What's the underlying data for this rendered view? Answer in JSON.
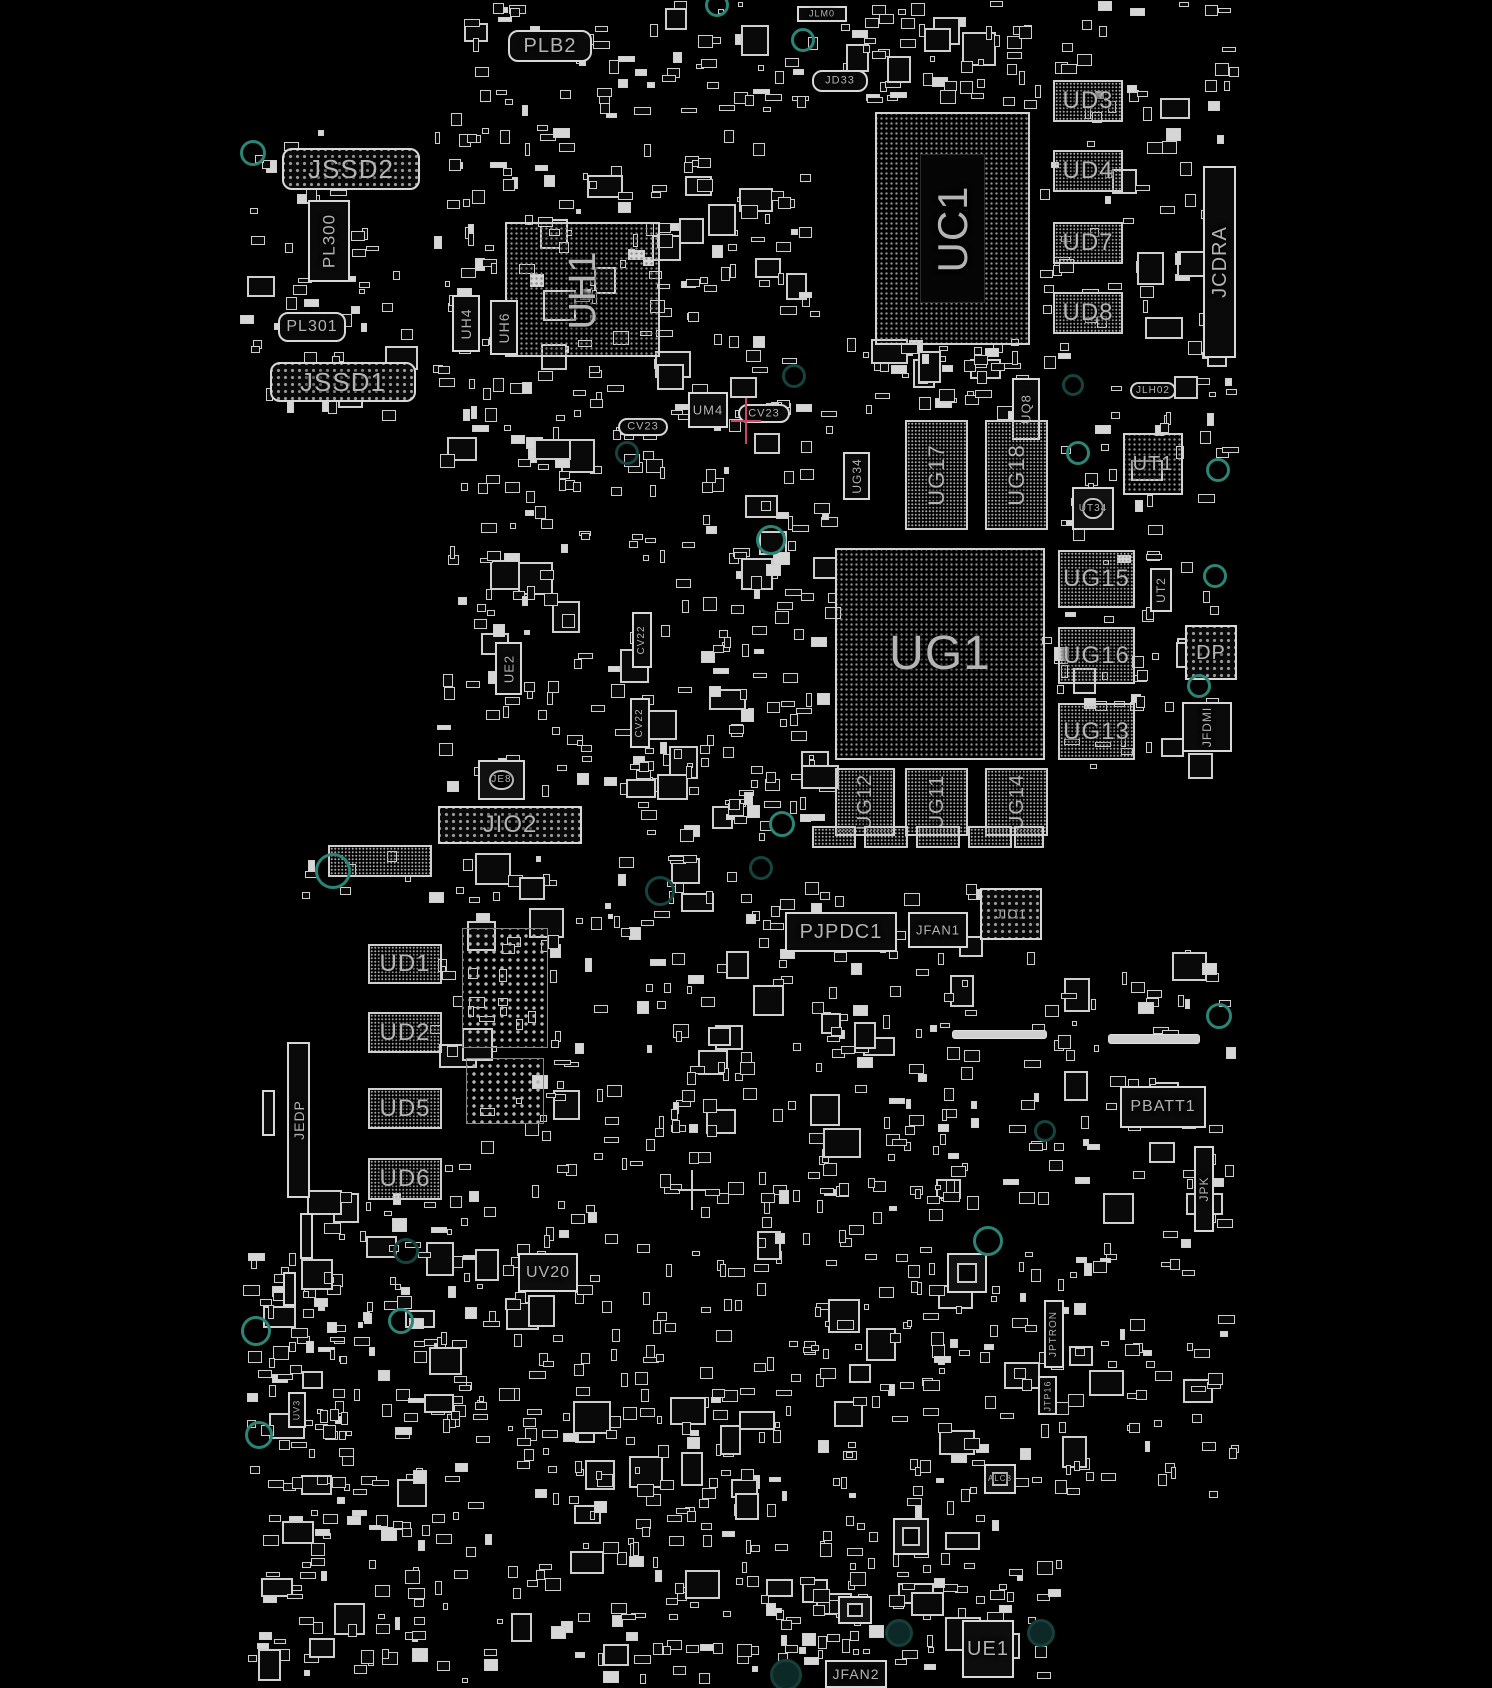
{
  "app": {
    "title": "PCB boardview — component placement"
  },
  "colors": {
    "background": "#000000",
    "silkscreen": "#d2d2d2",
    "label": "#b4b4b4",
    "mounting_hole": "#2b8577",
    "selection_cross": "#cc4466"
  },
  "boards": [
    {
      "name": "top-board",
      "elements": [
        {
          "type": "conn",
          "label": "JSSD2",
          "x": 282,
          "y": 148,
          "w": 138,
          "h": 42,
          "size": 26,
          "round": true,
          "pins": true
        },
        {
          "type": "vconn",
          "label": "PL300",
          "x": 308,
          "y": 200,
          "w": 42,
          "h": 82,
          "size": 17
        },
        {
          "type": "conn",
          "label": "PL301",
          "x": 278,
          "y": 312,
          "w": 68,
          "h": 30,
          "size": 16,
          "round": true
        },
        {
          "type": "conn",
          "label": "JSSD1",
          "x": 270,
          "y": 362,
          "w": 146,
          "h": 40,
          "size": 26,
          "round": true,
          "pins": true
        },
        {
          "type": "conn",
          "label": "PLB2",
          "x": 508,
          "y": 30,
          "w": 84,
          "h": 32,
          "size": 20,
          "round": true
        },
        {
          "type": "conn",
          "label": "JLM0",
          "x": 797,
          "y": 6,
          "w": 50,
          "h": 16,
          "size": 9
        },
        {
          "type": "conn",
          "label": "JD33",
          "x": 812,
          "y": 70,
          "w": 56,
          "h": 22,
          "size": 11,
          "round": true
        },
        {
          "type": "bga",
          "label": "UH1",
          "x": 505,
          "y": 222,
          "w": 155,
          "h": 135,
          "size": 38,
          "vert": true
        },
        {
          "type": "vconn",
          "label": "UH4",
          "x": 452,
          "y": 295,
          "w": 28,
          "h": 57,
          "size": 14
        },
        {
          "type": "vconn",
          "label": "UH6",
          "x": 490,
          "y": 300,
          "w": 28,
          "h": 55,
          "size": 14
        },
        {
          "type": "bga",
          "label": "UC1",
          "x": 875,
          "y": 112,
          "w": 155,
          "h": 233,
          "size": 42,
          "vert": true,
          "ring": true
        },
        {
          "type": "hatch",
          "label": "UD3",
          "x": 1053,
          "y": 80,
          "w": 70,
          "h": 42,
          "size": 24
        },
        {
          "type": "hatch",
          "label": "UD4",
          "x": 1053,
          "y": 150,
          "w": 70,
          "h": 42,
          "size": 24
        },
        {
          "type": "hatch",
          "label": "UD7",
          "x": 1053,
          "y": 222,
          "w": 70,
          "h": 42,
          "size": 24
        },
        {
          "type": "hatch",
          "label": "UD8",
          "x": 1053,
          "y": 292,
          "w": 70,
          "h": 42,
          "size": 24
        },
        {
          "type": "vconn",
          "label": "JCDRA",
          "x": 1203,
          "y": 166,
          "w": 33,
          "h": 192,
          "size": 20
        },
        {
          "type": "chip",
          "label": "UM4",
          "x": 688,
          "y": 392,
          "w": 40,
          "h": 36,
          "size": 13
        },
        {
          "type": "conn",
          "label": "CV23",
          "x": 738,
          "y": 404,
          "w": 52,
          "h": 19,
          "size": 11,
          "round": true
        },
        {
          "type": "conn",
          "label": "CV23",
          "x": 618,
          "y": 418,
          "w": 50,
          "h": 18,
          "size": 11,
          "round": true
        },
        {
          "type": "vconn",
          "label": "UG34",
          "x": 843,
          "y": 452,
          "w": 27,
          "h": 48,
          "size": 12
        },
        {
          "type": "vconn",
          "label": "UQ8",
          "x": 1012,
          "y": 378,
          "w": 28,
          "h": 62,
          "size": 13
        },
        {
          "type": "conn",
          "label": "JLH02",
          "x": 1130,
          "y": 382,
          "w": 46,
          "h": 17,
          "size": 10,
          "round": true
        },
        {
          "type": "hatch",
          "label": "UG17",
          "x": 905,
          "y": 420,
          "w": 63,
          "h": 110,
          "size": 22,
          "vert": true
        },
        {
          "type": "hatch",
          "label": "UG18",
          "x": 985,
          "y": 420,
          "w": 63,
          "h": 110,
          "size": 22,
          "vert": true
        },
        {
          "type": "bga",
          "label": "UT1",
          "x": 1123,
          "y": 433,
          "w": 60,
          "h": 62,
          "size": 20
        },
        {
          "type": "qfn",
          "label": "UT34",
          "x": 1072,
          "y": 487,
          "w": 42,
          "h": 43,
          "size": 10,
          "circle": true
        },
        {
          "type": "bga",
          "label": "UG1",
          "x": 835,
          "y": 548,
          "w": 210,
          "h": 212,
          "size": 48
        },
        {
          "type": "hatch",
          "label": "UG15",
          "x": 1058,
          "y": 550,
          "w": 77,
          "h": 58,
          "size": 24
        },
        {
          "type": "hatch",
          "label": "UG16",
          "x": 1058,
          "y": 627,
          "w": 77,
          "h": 57,
          "size": 24
        },
        {
          "type": "hatch",
          "label": "UG13",
          "x": 1058,
          "y": 703,
          "w": 77,
          "h": 57,
          "size": 24
        },
        {
          "type": "vconn",
          "label": "UT2",
          "x": 1150,
          "y": 568,
          "w": 22,
          "h": 44,
          "size": 12
        },
        {
          "type": "conn",
          "label": "DP",
          "x": 1185,
          "y": 625,
          "w": 52,
          "h": 55,
          "size": 20,
          "pins": true
        },
        {
          "type": "vconn",
          "label": "JFDMI",
          "x": 1182,
          "y": 702,
          "w": 50,
          "h": 50,
          "size": 12
        },
        {
          "type": "hatch",
          "label": "UG12",
          "x": 835,
          "y": 768,
          "w": 60,
          "h": 68,
          "size": 20,
          "vert": true
        },
        {
          "type": "hatch",
          "label": "UG11",
          "x": 905,
          "y": 768,
          "w": 63,
          "h": 68,
          "size": 20,
          "vert": true
        },
        {
          "type": "hatch",
          "label": "UG14",
          "x": 985,
          "y": 768,
          "w": 63,
          "h": 68,
          "size": 20,
          "vert": true
        },
        {
          "type": "vconn",
          "label": "UE2",
          "x": 495,
          "y": 642,
          "w": 27,
          "h": 53,
          "size": 13
        },
        {
          "type": "qfn",
          "label": "JE8",
          "x": 478,
          "y": 760,
          "w": 47,
          "h": 40,
          "size": 10,
          "circle": true
        },
        {
          "type": "vconn",
          "label": "CV22",
          "x": 632,
          "y": 612,
          "w": 20,
          "h": 56,
          "size": 10
        },
        {
          "type": "vconn",
          "label": "CV22",
          "x": 630,
          "y": 698,
          "w": 20,
          "h": 50,
          "size": 10
        },
        {
          "type": "conn",
          "label": "JIO2",
          "x": 438,
          "y": 806,
          "w": 144,
          "h": 38,
          "size": 24,
          "pins": true
        },
        {
          "type": "hatch",
          "label": "",
          "x": 812,
          "y": 826,
          "w": 44,
          "h": 22
        },
        {
          "type": "hatch",
          "label": "",
          "x": 864,
          "y": 826,
          "w": 44,
          "h": 22
        },
        {
          "type": "hatch",
          "label": "",
          "x": 916,
          "y": 826,
          "w": 44,
          "h": 22
        },
        {
          "type": "hatch",
          "label": "",
          "x": 968,
          "y": 826,
          "w": 44,
          "h": 22
        },
        {
          "type": "hatch",
          "label": "",
          "x": 1014,
          "y": 826,
          "w": 30,
          "h": 22
        },
        {
          "type": "hole",
          "x": 250,
          "y": 150,
          "r": 10
        },
        {
          "type": "hole",
          "x": 714,
          "y": 2,
          "r": 9
        },
        {
          "type": "hole",
          "x": 800,
          "y": 37,
          "r": 9
        },
        {
          "type": "hole",
          "x": 624,
          "y": 450,
          "r": 9,
          "dark": true
        },
        {
          "type": "hole",
          "x": 791,
          "y": 373,
          "r": 9,
          "dark": true
        },
        {
          "type": "hole",
          "x": 1070,
          "y": 382,
          "r": 8,
          "dark": true
        },
        {
          "type": "hole",
          "x": 1075,
          "y": 450,
          "r": 9
        },
        {
          "type": "hole",
          "x": 1215,
          "y": 467,
          "r": 9
        },
        {
          "type": "hole",
          "x": 768,
          "y": 537,
          "r": 12
        },
        {
          "type": "hole",
          "x": 1212,
          "y": 573,
          "r": 9
        },
        {
          "type": "hole",
          "x": 1196,
          "y": 683,
          "r": 9
        },
        {
          "type": "hole",
          "x": 779,
          "y": 821,
          "r": 10
        },
        {
          "type": "hole",
          "x": 758,
          "y": 865,
          "r": 9,
          "dark": true
        },
        {
          "type": "hole",
          "x": 657,
          "y": 888,
          "r": 12,
          "dark": true
        },
        {
          "type": "cross",
          "x": 746,
          "y": 421,
          "w": 30,
          "h": 46,
          "color": "#cc4466"
        }
      ]
    },
    {
      "name": "bottom-board",
      "elements": [
        {
          "type": "hatch",
          "label": "",
          "x": 328,
          "y": 845,
          "w": 104,
          "h": 32
        },
        {
          "type": "conn",
          "label": "PJPDC1",
          "x": 785,
          "y": 912,
          "w": 112,
          "h": 40,
          "size": 20,
          "pins": false
        },
        {
          "type": "conn",
          "label": "JFAN1",
          "x": 908,
          "y": 912,
          "w": 60,
          "h": 36,
          "size": 13
        },
        {
          "type": "conn",
          "label": "JIO1",
          "x": 980,
          "y": 888,
          "w": 62,
          "h": 52,
          "size": 13,
          "pins": true
        },
        {
          "type": "hatch",
          "label": "UD1",
          "x": 368,
          "y": 944,
          "w": 74,
          "h": 40,
          "size": 24
        },
        {
          "type": "hatch",
          "label": "UD2",
          "x": 368,
          "y": 1012,
          "w": 74,
          "h": 41,
          "size": 24
        },
        {
          "type": "hatch",
          "label": "UD5",
          "x": 368,
          "y": 1088,
          "w": 74,
          "h": 41,
          "size": 24
        },
        {
          "type": "hatch",
          "label": "UD6",
          "x": 368,
          "y": 1158,
          "w": 74,
          "h": 42,
          "size": 24
        },
        {
          "type": "vconn",
          "label": "JEDP",
          "x": 287,
          "y": 1042,
          "w": 23,
          "h": 156,
          "size": 14
        },
        {
          "type": "pingrid",
          "x": 462,
          "y": 928,
          "w": 86,
          "h": 120
        },
        {
          "type": "pingrid",
          "x": 466,
          "y": 1058,
          "w": 78,
          "h": 66
        },
        {
          "type": "chip",
          "label": "UV20",
          "x": 518,
          "y": 1253,
          "w": 60,
          "h": 39,
          "size": 16
        },
        {
          "type": "conn",
          "label": "PBATT1",
          "x": 1120,
          "y": 1086,
          "w": 86,
          "h": 42,
          "size": 16
        },
        {
          "type": "bar",
          "x": 1108,
          "y": 1034,
          "w": 92,
          "h": 10
        },
        {
          "type": "bar",
          "x": 952,
          "y": 1030,
          "w": 95,
          "h": 9
        },
        {
          "type": "vconn",
          "label": "JPK",
          "x": 1194,
          "y": 1146,
          "w": 20,
          "h": 86,
          "size": 12
        },
        {
          "type": "qfn",
          "label": "",
          "x": 947,
          "y": 1253,
          "w": 40,
          "h": 40
        },
        {
          "type": "vconn",
          "label": "JPTRON",
          "x": 1044,
          "y": 1300,
          "w": 20,
          "h": 68,
          "size": 10
        },
        {
          "type": "vconn",
          "label": "JTP16",
          "x": 1038,
          "y": 1376,
          "w": 19,
          "h": 39,
          "size": 9
        },
        {
          "type": "vconn",
          "label": "UV3",
          "x": 288,
          "y": 1392,
          "w": 18,
          "h": 36,
          "size": 9
        },
        {
          "type": "qfn",
          "label": "ALC8",
          "x": 984,
          "y": 1464,
          "w": 32,
          "h": 30,
          "size": 8
        },
        {
          "type": "qfn",
          "label": "",
          "x": 893,
          "y": 1518,
          "w": 36,
          "h": 37
        },
        {
          "type": "qfn",
          "label": "",
          "x": 838,
          "y": 1596,
          "w": 34,
          "h": 28
        },
        {
          "type": "chip",
          "label": "UE1",
          "x": 962,
          "y": 1620,
          "w": 52,
          "h": 58,
          "size": 20
        },
        {
          "type": "conn",
          "label": "JFAN2",
          "x": 825,
          "y": 1660,
          "w": 62,
          "h": 28,
          "size": 14
        },
        {
          "type": "vconn",
          "label": "",
          "x": 262,
          "y": 1090,
          "w": 13,
          "h": 46
        },
        {
          "type": "vconn",
          "label": "",
          "x": 300,
          "y": 1213,
          "w": 13,
          "h": 46
        },
        {
          "type": "vconn",
          "label": "",
          "x": 283,
          "y": 1272,
          "w": 13,
          "h": 34
        },
        {
          "type": "hole",
          "x": 330,
          "y": 868,
          "r": 15
        },
        {
          "type": "hole",
          "x": 403,
          "y": 1248,
          "r": 10,
          "dark": true
        },
        {
          "type": "hole",
          "x": 253,
          "y": 1328,
          "r": 12
        },
        {
          "type": "hole",
          "x": 398,
          "y": 1318,
          "r": 10
        },
        {
          "type": "hole",
          "x": 256,
          "y": 1432,
          "r": 11
        },
        {
          "type": "hole",
          "x": 1216,
          "y": 1013,
          "r": 10
        },
        {
          "type": "hole",
          "x": 1042,
          "y": 1128,
          "r": 8,
          "dark": true
        },
        {
          "type": "hole",
          "x": 985,
          "y": 1238,
          "r": 12
        },
        {
          "type": "hole",
          "x": 896,
          "y": 1630,
          "r": 11,
          "fill": true
        },
        {
          "type": "hole",
          "x": 1038,
          "y": 1630,
          "r": 11,
          "fill": true
        },
        {
          "type": "hole",
          "x": 783,
          "y": 1672,
          "r": 13,
          "fill": true
        },
        {
          "type": "cross",
          "x": 692,
          "y": 1190,
          "w": 28,
          "h": 40,
          "color": "#cccccc"
        }
      ]
    }
  ],
  "scatter_clusters": [
    {
      "x": 430,
      "y": 0,
      "w": 390,
      "h": 420,
      "count": 230,
      "seed": 11
    },
    {
      "x": 240,
      "y": 130,
      "w": 190,
      "h": 290,
      "count": 55,
      "seed": 12
    },
    {
      "x": 430,
      "y": 420,
      "w": 270,
      "h": 380,
      "count": 130,
      "seed": 13
    },
    {
      "x": 700,
      "y": 400,
      "w": 140,
      "h": 390,
      "count": 85,
      "seed": 14
    },
    {
      "x": 1040,
      "y": 0,
      "w": 200,
      "h": 400,
      "count": 80,
      "seed": 15
    },
    {
      "x": 840,
      "y": 330,
      "w": 200,
      "h": 90,
      "count": 45,
      "seed": 16
    },
    {
      "x": 1040,
      "y": 400,
      "w": 200,
      "h": 380,
      "count": 70,
      "seed": 17
    },
    {
      "x": 840,
      "y": 0,
      "w": 200,
      "h": 110,
      "count": 55,
      "seed": 18
    },
    {
      "x": 620,
      "y": 760,
      "w": 220,
      "h": 80,
      "count": 40,
      "seed": 19
    },
    {
      "x": 620,
      "y": 880,
      "w": 360,
      "h": 400,
      "count": 200,
      "seed": 21
    },
    {
      "x": 300,
      "y": 1180,
      "w": 320,
      "h": 290,
      "count": 150,
      "seed": 22
    },
    {
      "x": 620,
      "y": 1280,
      "w": 380,
      "h": 290,
      "count": 150,
      "seed": 23
    },
    {
      "x": 1000,
      "y": 950,
      "w": 240,
      "h": 350,
      "count": 80,
      "seed": 24
    },
    {
      "x": 240,
      "y": 1460,
      "w": 190,
      "h": 220,
      "count": 80,
      "seed": 25
    },
    {
      "x": 430,
      "y": 1460,
      "w": 330,
      "h": 225,
      "count": 100,
      "seed": 26
    },
    {
      "x": 760,
      "y": 1560,
      "w": 300,
      "h": 125,
      "count": 80,
      "seed": 27
    },
    {
      "x": 430,
      "y": 900,
      "w": 190,
      "h": 280,
      "count": 60,
      "seed": 28
    },
    {
      "x": 1000,
      "y": 1300,
      "w": 240,
      "h": 200,
      "count": 60,
      "seed": 29
    },
    {
      "x": 300,
      "y": 848,
      "w": 440,
      "h": 55,
      "count": 30,
      "seed": 30
    },
    {
      "x": 240,
      "y": 1250,
      "w": 110,
      "h": 210,
      "count": 45,
      "seed": 31
    }
  ]
}
